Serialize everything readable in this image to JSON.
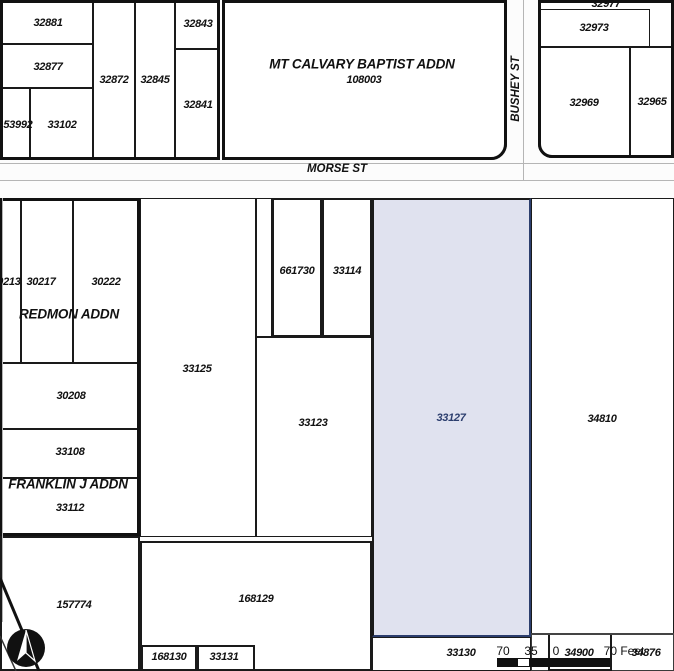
{
  "map": {
    "colors": {
      "background": "#fcfcfc",
      "parcel_fill": "#ffffff",
      "line": "#1a1a1a",
      "street_line": "#b5b5b5",
      "selected_fill": "#e0e2ef",
      "selected_outline": "#2c3e6e",
      "selected_label": "#2c3e6e"
    },
    "streets": [
      {
        "label": "MORSE ST",
        "x": 337,
        "y": 169,
        "vertical": false
      },
      {
        "label": "BUSHEY ST",
        "x": 516,
        "y": 89,
        "vertical": true
      }
    ],
    "addition_labels": [
      {
        "label": "MT CALVARY BAPTIST ADDN",
        "x": 362,
        "y": 64
      },
      {
        "label": "REDMON ADDN",
        "x": 69,
        "y": 314
      },
      {
        "label": "FRANKLIN J ADDN",
        "x": 68,
        "y": 484
      }
    ],
    "parcels": [
      {
        "id": "32881",
        "rect": [
          0,
          0,
          93,
          44
        ],
        "label_at": [
          48,
          23
        ]
      },
      {
        "id": "32877",
        "rect": [
          0,
          44,
          93,
          44
        ],
        "label_at": [
          48,
          67
        ]
      },
      {
        "id": "153992",
        "rect": [
          0,
          88,
          30,
          72
        ],
        "label_at": [
          15,
          125
        ]
      },
      {
        "id": "33102",
        "rect": [
          30,
          88,
          63,
          72
        ],
        "label_at": [
          62,
          125
        ]
      },
      {
        "id": "32872",
        "rect": [
          93,
          0,
          42,
          160
        ],
        "label_at": [
          114,
          80
        ]
      },
      {
        "id": "32845",
        "rect": [
          135,
          0,
          40,
          160
        ],
        "label_at": [
          155,
          80
        ]
      },
      {
        "id": "32843",
        "rect": [
          175,
          0,
          45,
          49
        ],
        "label_at": [
          198,
          24
        ]
      },
      {
        "id": "32841",
        "rect": [
          175,
          49,
          45,
          111
        ],
        "label_at": [
          198,
          105
        ]
      },
      {
        "id": "108003",
        "rect": [
          222,
          0,
          285,
          160
        ],
        "label_at": [
          364,
          80
        ],
        "radius": "0 0 16px 0"
      },
      {
        "id": "32977",
        "rect": [
          538,
          0,
          136,
          47
        ],
        "label_at": [
          606,
          4
        ]
      },
      {
        "id": "32973",
        "rect": [
          538,
          9,
          112,
          38
        ],
        "label_at": [
          594,
          28
        ]
      },
      {
        "id": "32969",
        "rect": [
          538,
          47,
          92,
          111
        ],
        "label_at": [
          584,
          103
        ],
        "radius": "0 0 0 14px"
      },
      {
        "id": "32965",
        "rect": [
          630,
          47,
          44,
          111
        ],
        "label_at": [
          652,
          102
        ]
      },
      {
        "id": "30213",
        "rect": [
          0,
          198,
          21,
          165
        ],
        "label_at": [
          6,
          282
        ]
      },
      {
        "id": "30217",
        "rect": [
          21,
          198,
          52,
          165
        ],
        "label_at": [
          41,
          282
        ]
      },
      {
        "id": "30222",
        "rect": [
          73,
          198,
          67,
          165
        ],
        "label_at": [
          106,
          282
        ]
      },
      {
        "id": "30208",
        "rect": [
          0,
          363,
          140,
          66
        ],
        "label_at": [
          71,
          396
        ]
      },
      {
        "id": "33108",
        "rect": [
          0,
          429,
          140,
          49
        ],
        "label_at": [
          70,
          452
        ]
      },
      {
        "id": "33112",
        "rect": [
          0,
          478,
          140,
          58
        ],
        "label_at": [
          70,
          508
        ]
      },
      {
        "id": "157774",
        "rect": [
          0,
          536,
          140,
          135
        ],
        "label_at": [
          74,
          605
        ],
        "weight": "bold"
      },
      {
        "id": "33125",
        "rect": [
          140,
          198,
          116,
          339
        ],
        "label_at": [
          197,
          369
        ]
      },
      {
        "id": "",
        "rect": [
          256,
          198,
          16,
          139
        ]
      },
      {
        "id": "33123",
        "rect": [
          256,
          337,
          116,
          200
        ],
        "label_at": [
          313,
          423
        ]
      },
      {
        "id": "661730",
        "rect": [
          272,
          198,
          50,
          139
        ],
        "label_at": [
          297,
          271
        ],
        "weight": "bold"
      },
      {
        "id": "33114",
        "rect": [
          322,
          198,
          50,
          139
        ],
        "label_at": [
          347,
          271
        ],
        "weight": "bold"
      },
      {
        "id": "168129",
        "rect": [
          140,
          541,
          232,
          130
        ],
        "label_at": [
          256,
          599
        ],
        "weight": "bold"
      },
      {
        "id": "168130",
        "rect": [
          141,
          645,
          56,
          26
        ],
        "label_at": [
          169,
          657
        ],
        "weight": "bold"
      },
      {
        "id": "33131",
        "rect": [
          197,
          645,
          58,
          26
        ],
        "label_at": [
          224,
          657
        ],
        "weight": "bold"
      },
      {
        "id": "34810",
        "rect": [
          531,
          198,
          143,
          436
        ],
        "label_at": [
          602,
          419
        ]
      },
      {
        "id": "33127",
        "rect": [
          372,
          198,
          159,
          439
        ],
        "label_at": [
          451,
          418
        ],
        "selected": true
      },
      {
        "id": "33130",
        "rect": [
          372,
          637,
          159,
          34
        ],
        "label_at": [
          461,
          653
        ]
      },
      {
        "id": "34876",
        "rect": [
          531,
          634,
          143,
          37
        ],
        "label_at": [
          646,
          653
        ],
        "thin": true
      },
      {
        "id": "34900",
        "rect": [
          548,
          633,
          64,
          38
        ],
        "label_at": [
          579,
          653
        ],
        "weight": "bold"
      }
    ],
    "blocks": [
      {
        "rect": [
          0,
          0,
          220,
          160
        ]
      },
      {
        "rect": [
          222,
          0,
          285,
          160
        ],
        "radius": "0 0 16px 0"
      },
      {
        "rect": [
          538,
          0,
          136,
          158
        ],
        "radius": "0 0 0 14px"
      },
      {
        "rect": [
          0,
          198,
          140,
          338
        ]
      }
    ],
    "street_lines": [
      {
        "rect": [
          0,
          163,
          674,
          1
        ]
      },
      {
        "rect": [
          0,
          180,
          674,
          1
        ]
      },
      {
        "rect": [
          523,
          0,
          1,
          180
        ]
      },
      {
        "rect": [
          2,
          198,
          1,
          424
        ]
      }
    ],
    "boundary_lines": [
      {
        "rect": [
          531,
          633,
          143,
          2
        ]
      }
    ],
    "scale_bar": {
      "labels": [
        {
          "text": "70",
          "x": 503,
          "y": 651
        },
        {
          "text": "35",
          "x": 531,
          "y": 651
        },
        {
          "text": "0",
          "x": 556,
          "y": 651
        },
        {
          "text": "70 Feet",
          "x": 624,
          "y": 651
        }
      ],
      "segments": [
        {
          "rect": [
            497,
            658,
            20,
            9
          ],
          "fill": "#111111"
        },
        {
          "rect": [
            517,
            658,
            13,
            9
          ],
          "fill": "#ffffff"
        },
        {
          "rect": [
            530,
            658,
            80,
            9
          ],
          "fill": "#111111"
        }
      ]
    },
    "north_arrow_icon": "compass-north-arrow"
  }
}
